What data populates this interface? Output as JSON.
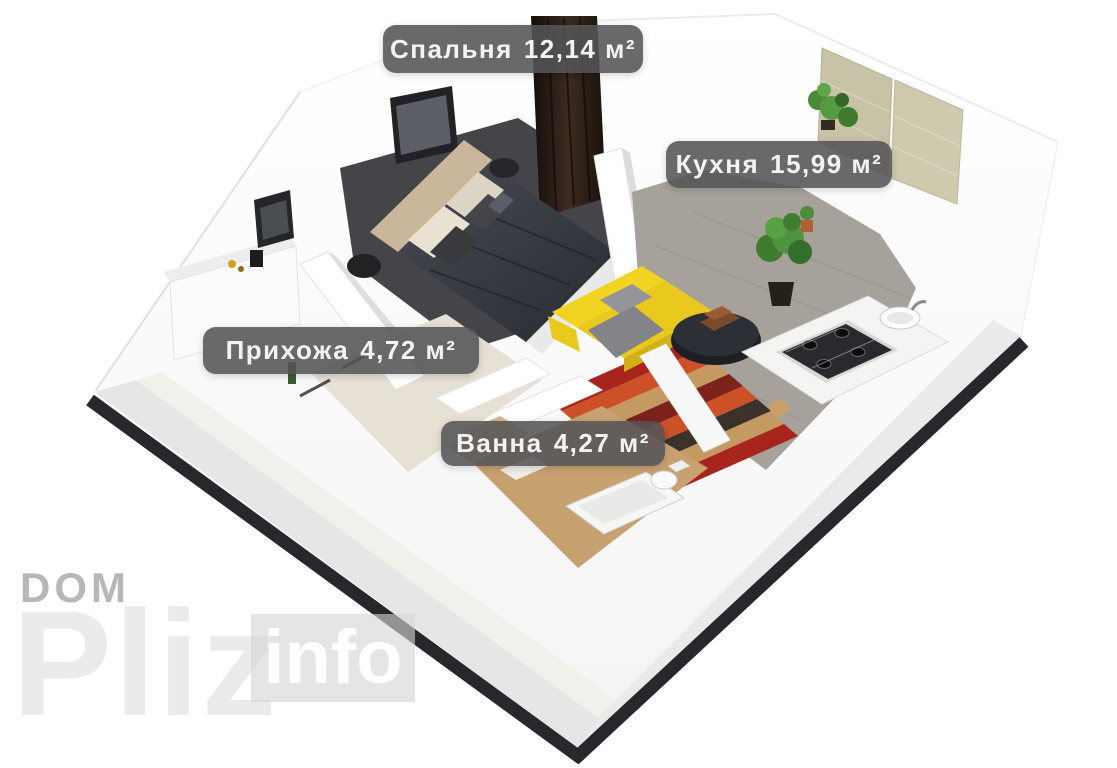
{
  "floorplan": {
    "type": "3d-apartment-floorplan",
    "rooms": [
      {
        "id": "bedroom",
        "name": "Спальня",
        "area": "12,14 м²"
      },
      {
        "id": "kitchen",
        "name": "Кухня",
        "area": "15,99 м²"
      },
      {
        "id": "hallway",
        "name": "Прихожа",
        "area": "4,72 м²"
      },
      {
        "id": "bathroom",
        "name": "Ванна",
        "area": "4,27 м²"
      }
    ]
  },
  "watermark": {
    "top": "DOM",
    "big": "Pliz",
    "badge": "info"
  },
  "colors": {
    "background": "#ffffff",
    "label_bg": "rgba(84,84,87,0.88)",
    "label_text": "#f3f3f3",
    "plinth": "#28282c",
    "bedroom_floor": "#454549",
    "kitchen_floor": "#a6a29b",
    "bathroom_floor": "#c8a171",
    "hallway_floor": "#e6e0d5",
    "sofa_yellow": "#f2d321",
    "rug_red": "#a8251d",
    "bed_duvet": "#3a3e45",
    "headboard": "#c9b69b",
    "curtain": "#2a1d16",
    "blinds": "#c8c3a6",
    "watermark_gray": "#b7b7b7",
    "watermark_light": "#ebebeb"
  }
}
